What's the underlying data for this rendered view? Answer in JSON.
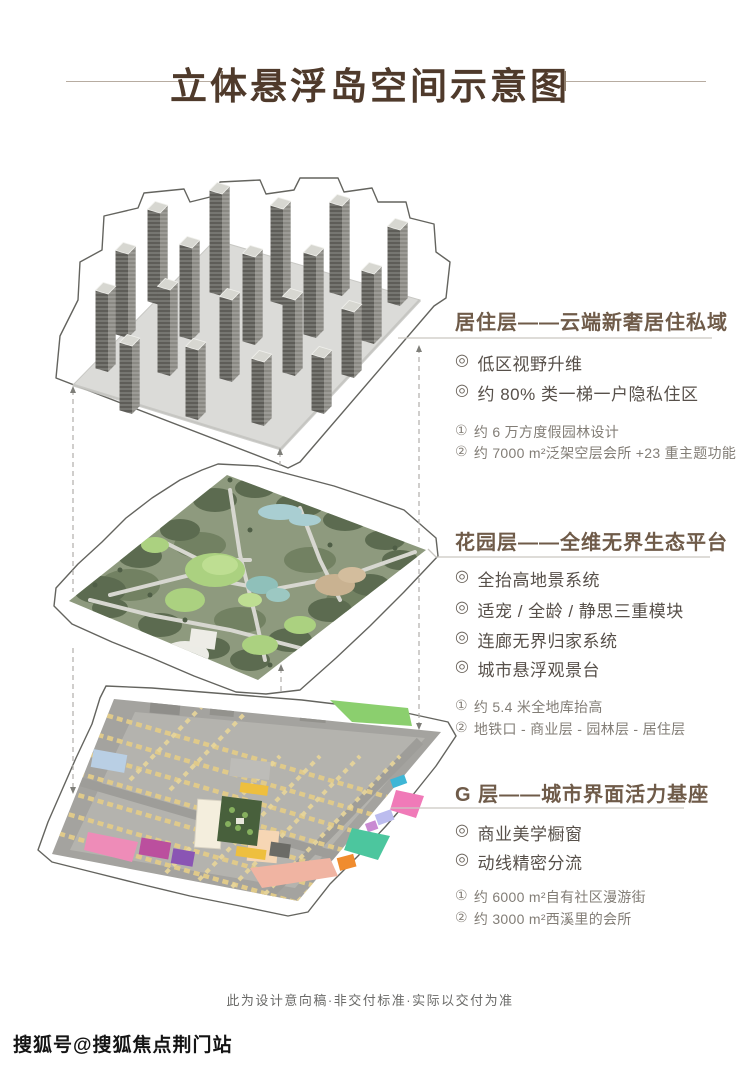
{
  "page": {
    "title": "立体悬浮岛空间示意图",
    "disclaimer": "此为设计意向稿·非交付标准·实际以交付为准",
    "watermark": "搜狐号@搜狐焦点荆门站"
  },
  "glyphs": {
    "bullet": "◎",
    "n1": "①",
    "n2": "②"
  },
  "colors": {
    "title_brown": "#4f3a2b",
    "heading_brown": "#6f5b49",
    "bullet_text": "#57504a",
    "note_text": "#827d76",
    "line_gray": "#c9c6c1",
    "island_outline": "#64645f",
    "parking_yellow": "#e0ca8a",
    "garden_green": "#8e9a7e"
  },
  "sections": [
    {
      "heading": "居住层——云端新奢居住私域",
      "bullets": [
        "低区视野升维",
        "约 80% 类一梯一户隐私住区"
      ],
      "notes": [
        "约 6 万方度假园林设计",
        "约 7000 m²泛架空层会所 +23 重主题功能"
      ]
    },
    {
      "heading": "花园层——全维无界生态平台",
      "bullets": [
        "全抬高地景系统",
        "适宠 / 全龄 / 静思三重模块",
        "连廊无界归家系统",
        "城市悬浮观景台"
      ],
      "notes": [
        "约 5.4 米全地库抬高",
        "地铁口 - 商业层 - 园林层 - 居住层"
      ]
    },
    {
      "heading": "G 层——城市界面活力基座",
      "bullets": [
        "商业美学橱窗",
        "动线精密分流"
      ],
      "notes": [
        "约 6000 m²自有社区漫游街",
        "约 3000 m²西溪里的会所"
      ]
    }
  ]
}
